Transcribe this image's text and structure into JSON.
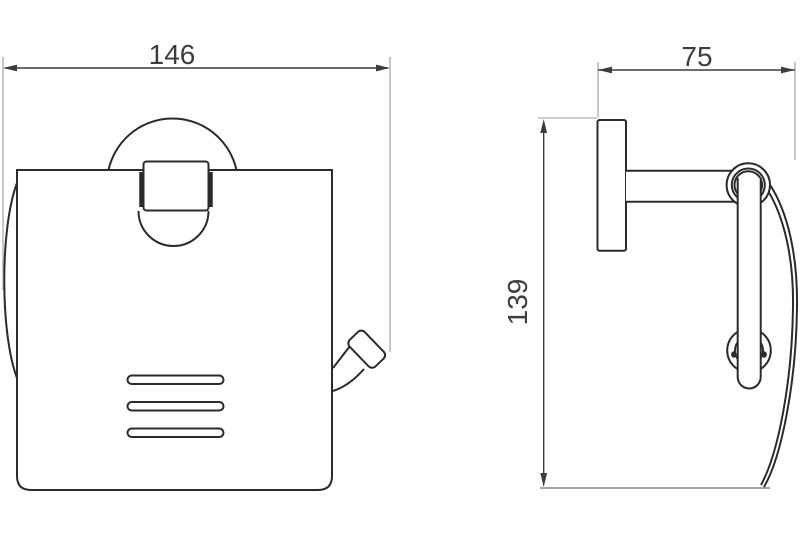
{
  "drawing": {
    "background": "#ffffff",
    "object_line_color": "#2b2b2b",
    "dimension_line_color": "#3d3d3d",
    "extension_line_color": "#9b9b9b",
    "dimensions": {
      "front_width": "146",
      "side_depth": "75",
      "side_height": "139"
    }
  }
}
